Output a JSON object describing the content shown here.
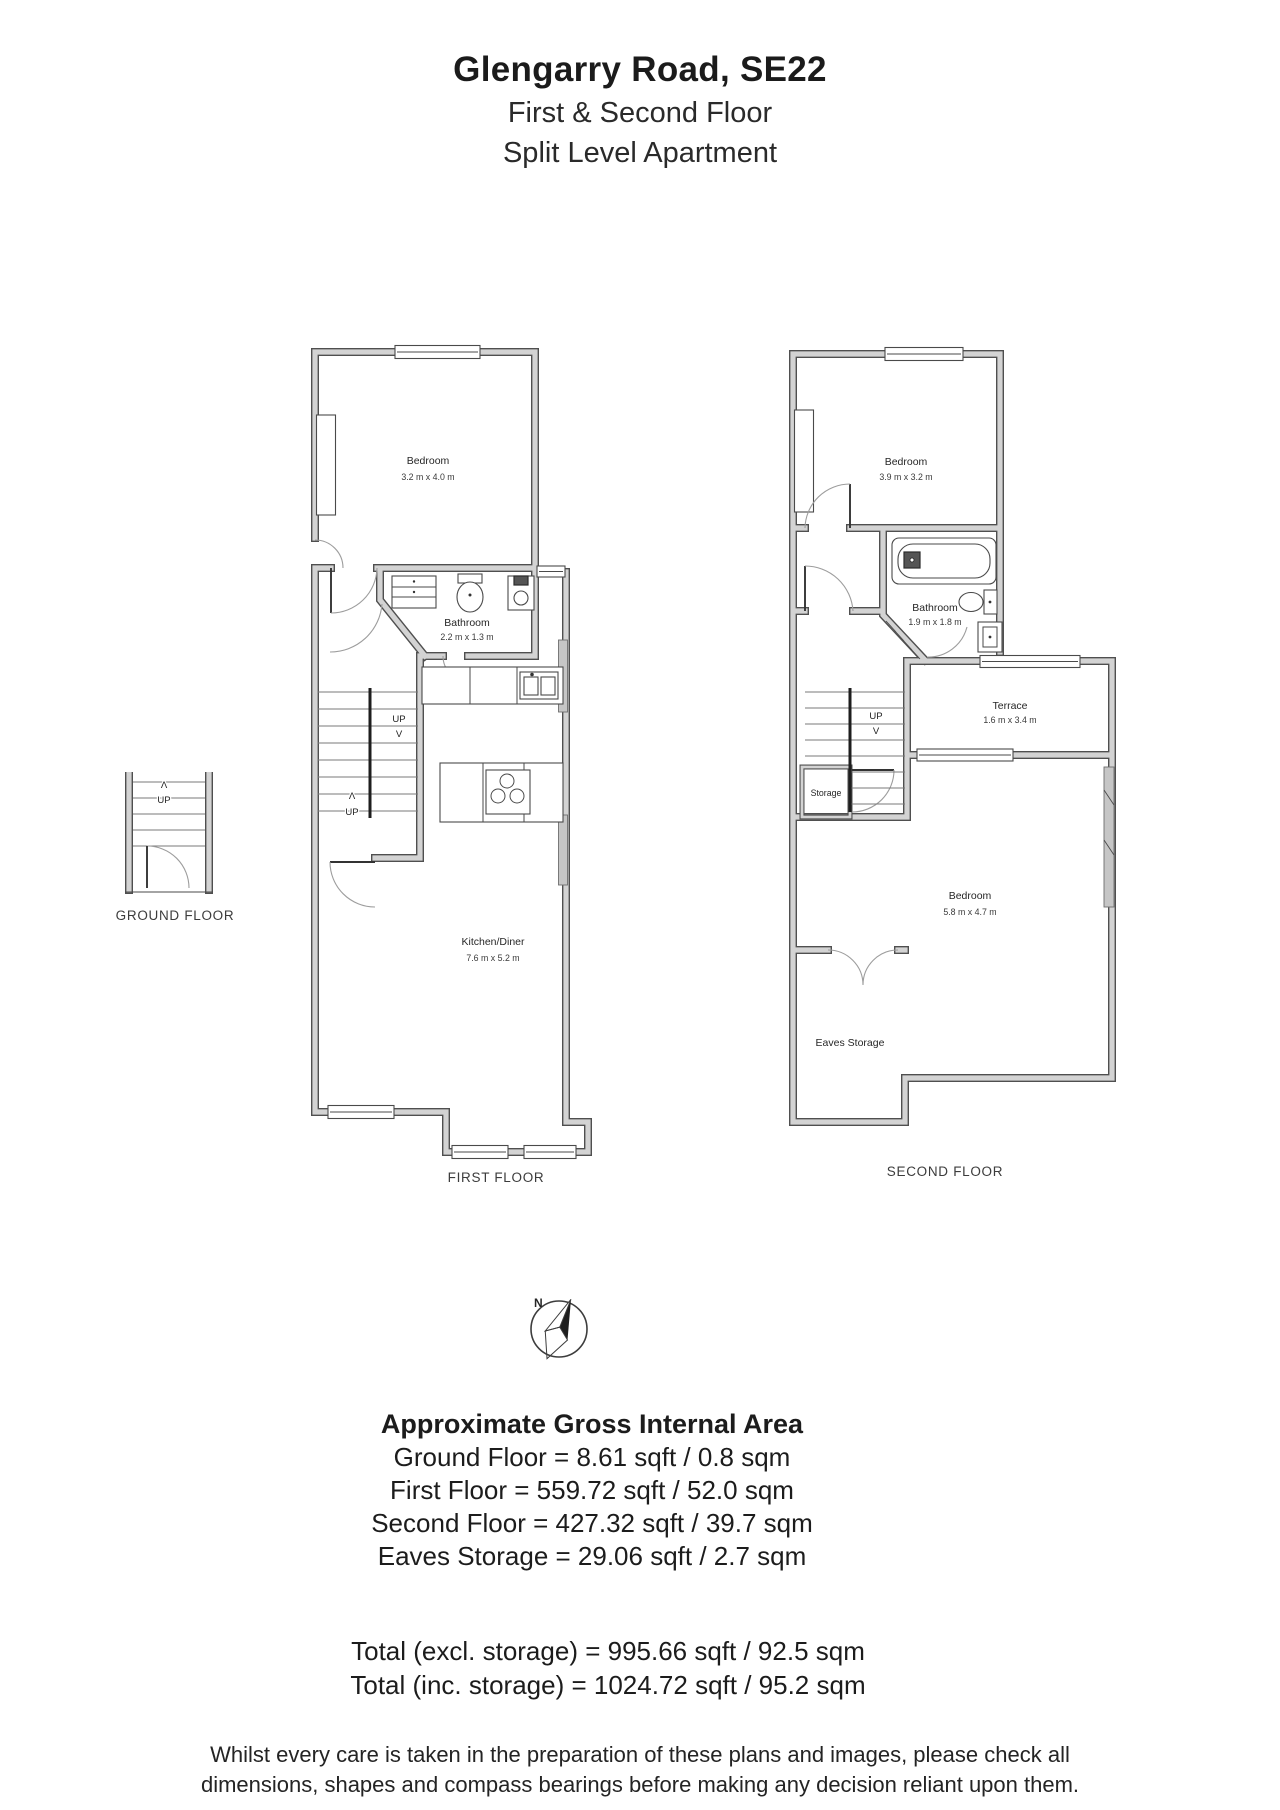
{
  "header": {
    "title": "Glengarry Road, SE22",
    "line2": "First & Second Floor",
    "line3": "Split Level Apartment"
  },
  "floors": {
    "ground": {
      "label": "GROUND FLOOR",
      "stairs": {
        "arrow_up": "Λ",
        "up": "UP"
      }
    },
    "first": {
      "label": "FIRST FLOOR",
      "bedroom": {
        "name": "Bedroom",
        "dims": "3.2 m x 4.0 m"
      },
      "bathroom": {
        "name": "Bathroom",
        "dims": "2.2 m x 1.3 m"
      },
      "kitchen": {
        "name": "Kitchen/Diner",
        "dims": "7.6 m x 5.2 m"
      },
      "stairs_upper": {
        "up": "UP",
        "arrow_down": "V"
      },
      "stairs_lower": {
        "arrow_up": "Λ",
        "up": "UP"
      }
    },
    "second": {
      "label": "SECOND FLOOR",
      "bedroom_front": {
        "name": "Bedroom",
        "dims": "3.9 m x 3.2 m"
      },
      "bathroom": {
        "name": "Bathroom",
        "dims": "1.9 m x 1.8 m"
      },
      "terrace": {
        "name": "Terrace",
        "dims": "1.6 m x 3.4 m"
      },
      "storage": {
        "name": "Storage"
      },
      "bedroom_rear": {
        "name": "Bedroom",
        "dims": "5.8 m x 4.7 m"
      },
      "eaves_storage": {
        "name": "Eaves Storage"
      },
      "stairs": {
        "up": "UP",
        "arrow_down": "V"
      }
    }
  },
  "compass": {
    "north": "N"
  },
  "area_summary": {
    "heading": "Approximate Gross Internal Area",
    "lines": [
      "Ground Floor = 8.61 sqft / 0.8 sqm",
      "First Floor = 559.72 sqft / 52.0 sqm",
      "Second Floor = 427.32 sqft / 39.7 sqm",
      "Eaves Storage =  29.06 sqft / 2.7 sqm"
    ],
    "totals": [
      "Total (excl. storage) = 995.66 sqft / 92.5 sqm",
      "Total (inc. storage) = 1024.72 sqft / 95.2 sqm"
    ]
  },
  "disclaimer": {
    "line1": "Whilst every care is taken in the preparation of these plans and images, please check all",
    "line2": "dimensions, shapes and compass bearings before making any decision reliant upon them."
  },
  "colors": {
    "wall_fill": "#d3d3d3",
    "wall_edge": "#4f4f4f",
    "text": "#1e1e1e"
  }
}
